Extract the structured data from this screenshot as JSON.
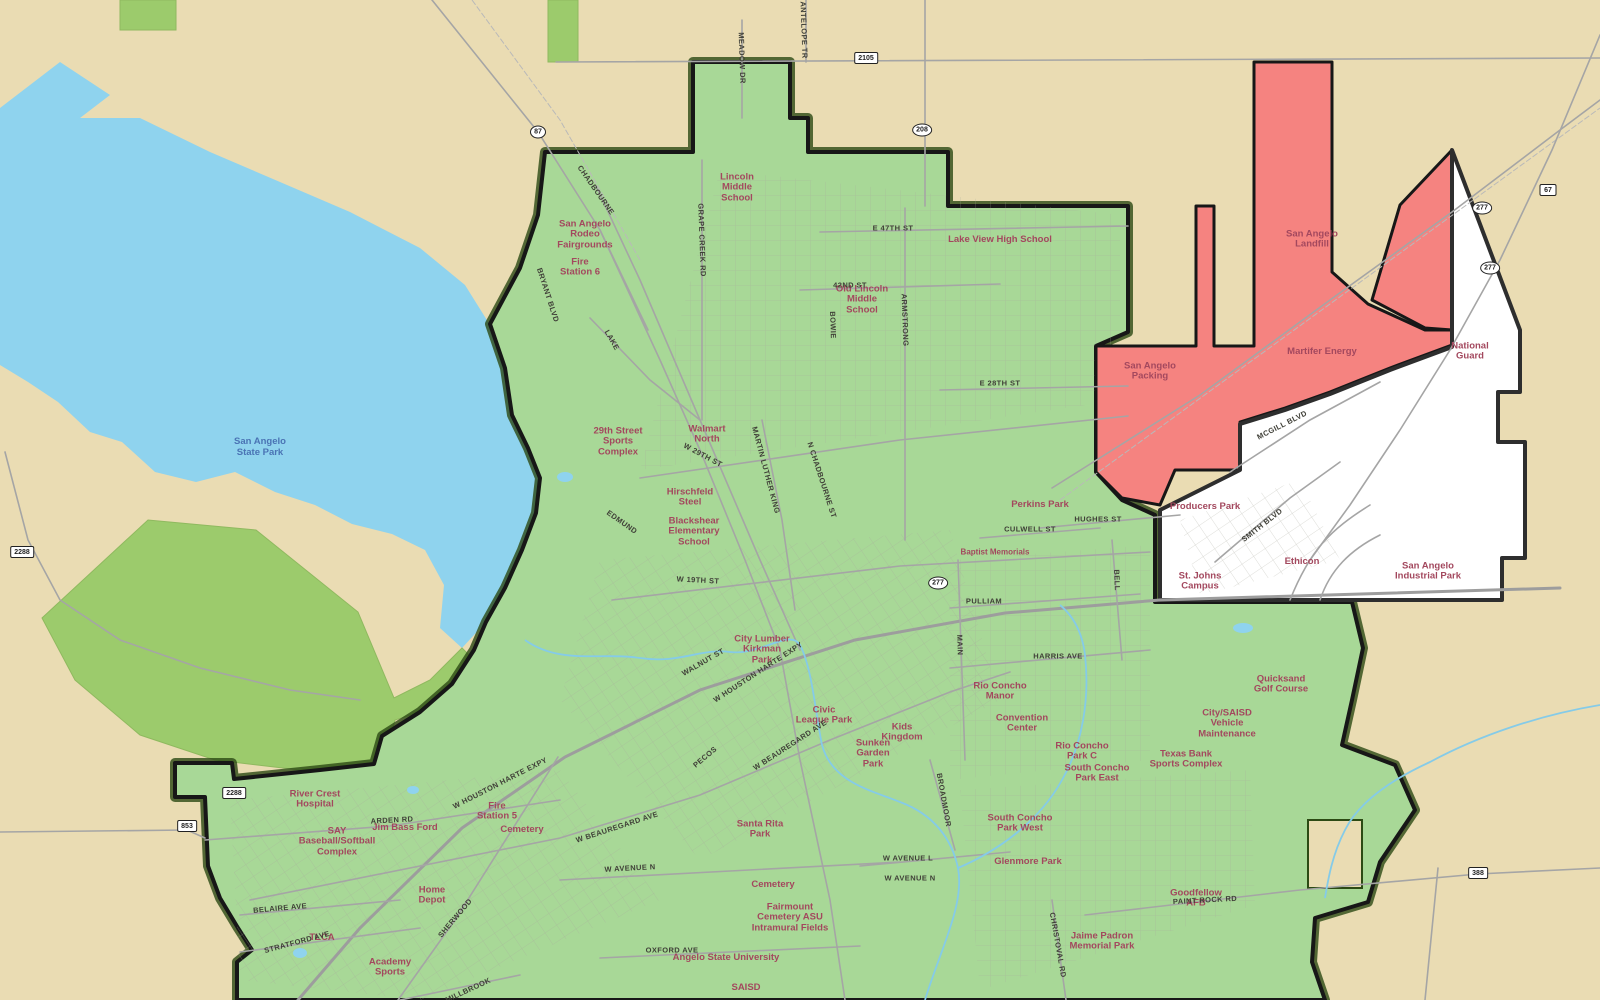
{
  "map": {
    "colors": {
      "background_tan": "#EADCB3",
      "lake_blue": "#8FD3EE",
      "city_green": "#A8D897",
      "park_olive": "#9CCB6C",
      "annexation_red": "#F58380",
      "industrial_white": "#FFFFFF",
      "boundary_black": "#171717",
      "road_gray": "#A5A5A5",
      "place_label": "#A3485E",
      "street_label": "#3F3F37",
      "water_label": "#4A73B4"
    },
    "labels": {
      "water": [
        {
          "text": "San Angelo State Park"
        }
      ],
      "places": [
        {
          "text": "San Angelo Rodeo Fairgrounds"
        },
        {
          "text": "Lincoln Middle School"
        },
        {
          "text": "Lake View High School"
        },
        {
          "text": "Fire Station 6"
        },
        {
          "text": "Old Lincoln Middle School"
        },
        {
          "text": "29th Street Sports Complex"
        },
        {
          "text": "Walmart North"
        },
        {
          "text": "Hirschfeld Steel"
        },
        {
          "text": "Blackshear Elementary School"
        },
        {
          "text": "San Angelo Packing"
        },
        {
          "text": "San Angelo Landfill"
        },
        {
          "text": "Martifer Energy"
        },
        {
          "text": "National Guard"
        },
        {
          "text": "Producers Park"
        },
        {
          "text": "Ethicon"
        },
        {
          "text": "St. Johns Campus"
        },
        {
          "text": "San Angelo Industrial Park"
        },
        {
          "text": "Perkins Park"
        },
        {
          "text": "Baptist Memorials"
        },
        {
          "text": "Rio Concho Manor"
        },
        {
          "text": "Convention Center"
        },
        {
          "text": "Kids Kingdom"
        },
        {
          "text": "Sunken Garden Park"
        },
        {
          "text": "Civic League Park"
        },
        {
          "text": "City Lumber Kirkman Park"
        },
        {
          "text": "Santa Rita Park"
        },
        {
          "text": "Cemetery"
        },
        {
          "text": "Fairmount Cemetery ASU Intramural Fields"
        },
        {
          "text": "Angelo State University"
        },
        {
          "text": "SAISD"
        },
        {
          "text": "Jaime Padron Memorial Park"
        },
        {
          "text": "South Concho Park West"
        },
        {
          "text": "Glenmore Park"
        },
        {
          "text": "Rio Concho Park C"
        },
        {
          "text": "South Concho Park East"
        },
        {
          "text": "Quicksand Golf Course"
        },
        {
          "text": "City/SAISD Vehicle Maintenance"
        },
        {
          "text": "Texas Bank Sports Complex"
        },
        {
          "text": "Goodfellow AFB"
        },
        {
          "text": "River Crest Hospital"
        },
        {
          "text": "SAY Baseball/Softball Complex"
        },
        {
          "text": "Jim Bass Ford"
        },
        {
          "text": "Fire Station 5"
        },
        {
          "text": "Cemetery"
        },
        {
          "text": "Home Depot"
        },
        {
          "text": "Academy Sports"
        },
        {
          "text": "TLCA"
        }
      ],
      "streets": [
        {
          "text": "CHADBOURNE"
        },
        {
          "text": "BRYANT BLVD"
        },
        {
          "text": "LAKE"
        },
        {
          "text": "GRAPE CREEK RD"
        },
        {
          "text": "MEADOW DR"
        },
        {
          "text": "ARMSTRONG"
        },
        {
          "text": "BOWIE"
        },
        {
          "text": "E 47TH ST"
        },
        {
          "text": "42ND ST"
        },
        {
          "text": "E 28TH ST"
        },
        {
          "text": "W 29TH ST"
        },
        {
          "text": "MARTIN LUTHER KING"
        },
        {
          "text": "N CHADBOURNE ST"
        },
        {
          "text": "EDMUND"
        },
        {
          "text": "W 19TH ST"
        },
        {
          "text": "W HOUSTON HARTE EXPY"
        },
        {
          "text": "WALNUT ST"
        },
        {
          "text": "PECOS"
        },
        {
          "text": "W BEAUREGARD AVE"
        },
        {
          "text": "W BEAUREGARD AVE"
        },
        {
          "text": "W AVENUE N"
        },
        {
          "text": "W AVENUE L"
        },
        {
          "text": "W AVENUE N"
        },
        {
          "text": "OXFORD AVE"
        },
        {
          "text": "SHERWOOD"
        },
        {
          "text": "MILLBROOK"
        },
        {
          "text": "STRATFORD AVE"
        },
        {
          "text": "BELAIRE AVE"
        },
        {
          "text": "ARDEN RD"
        },
        {
          "text": "W HOUSTON HARTE EXPY"
        },
        {
          "text": "HUGHES ST"
        },
        {
          "text": "CULWELL ST"
        },
        {
          "text": "PULLIAM"
        },
        {
          "text": "HARRIS AVE"
        },
        {
          "text": "MAIN"
        },
        {
          "text": "BELL"
        },
        {
          "text": "MCGILL BLVD"
        },
        {
          "text": "SMITH BLVD"
        },
        {
          "text": "PAINT ROCK RD"
        },
        {
          "text": "CHRISTOVAL RD"
        },
        {
          "text": "BROADMOOR"
        },
        {
          "text": "ANTELOPE TR"
        }
      ],
      "shields": [
        {
          "shape": "oval",
          "text": "87"
        },
        {
          "shape": "oval",
          "text": "208"
        },
        {
          "shape": "oval",
          "text": "277"
        },
        {
          "shape": "oval",
          "text": "277"
        },
        {
          "shape": "rect",
          "text": "67"
        },
        {
          "shape": "oval",
          "text": "277"
        },
        {
          "shape": "rect",
          "text": "2105"
        },
        {
          "shape": "rect",
          "text": "2288"
        },
        {
          "shape": "rect",
          "text": "2288"
        },
        {
          "shape": "rect",
          "text": "853"
        },
        {
          "shape": "rect",
          "text": "388"
        }
      ]
    }
  }
}
